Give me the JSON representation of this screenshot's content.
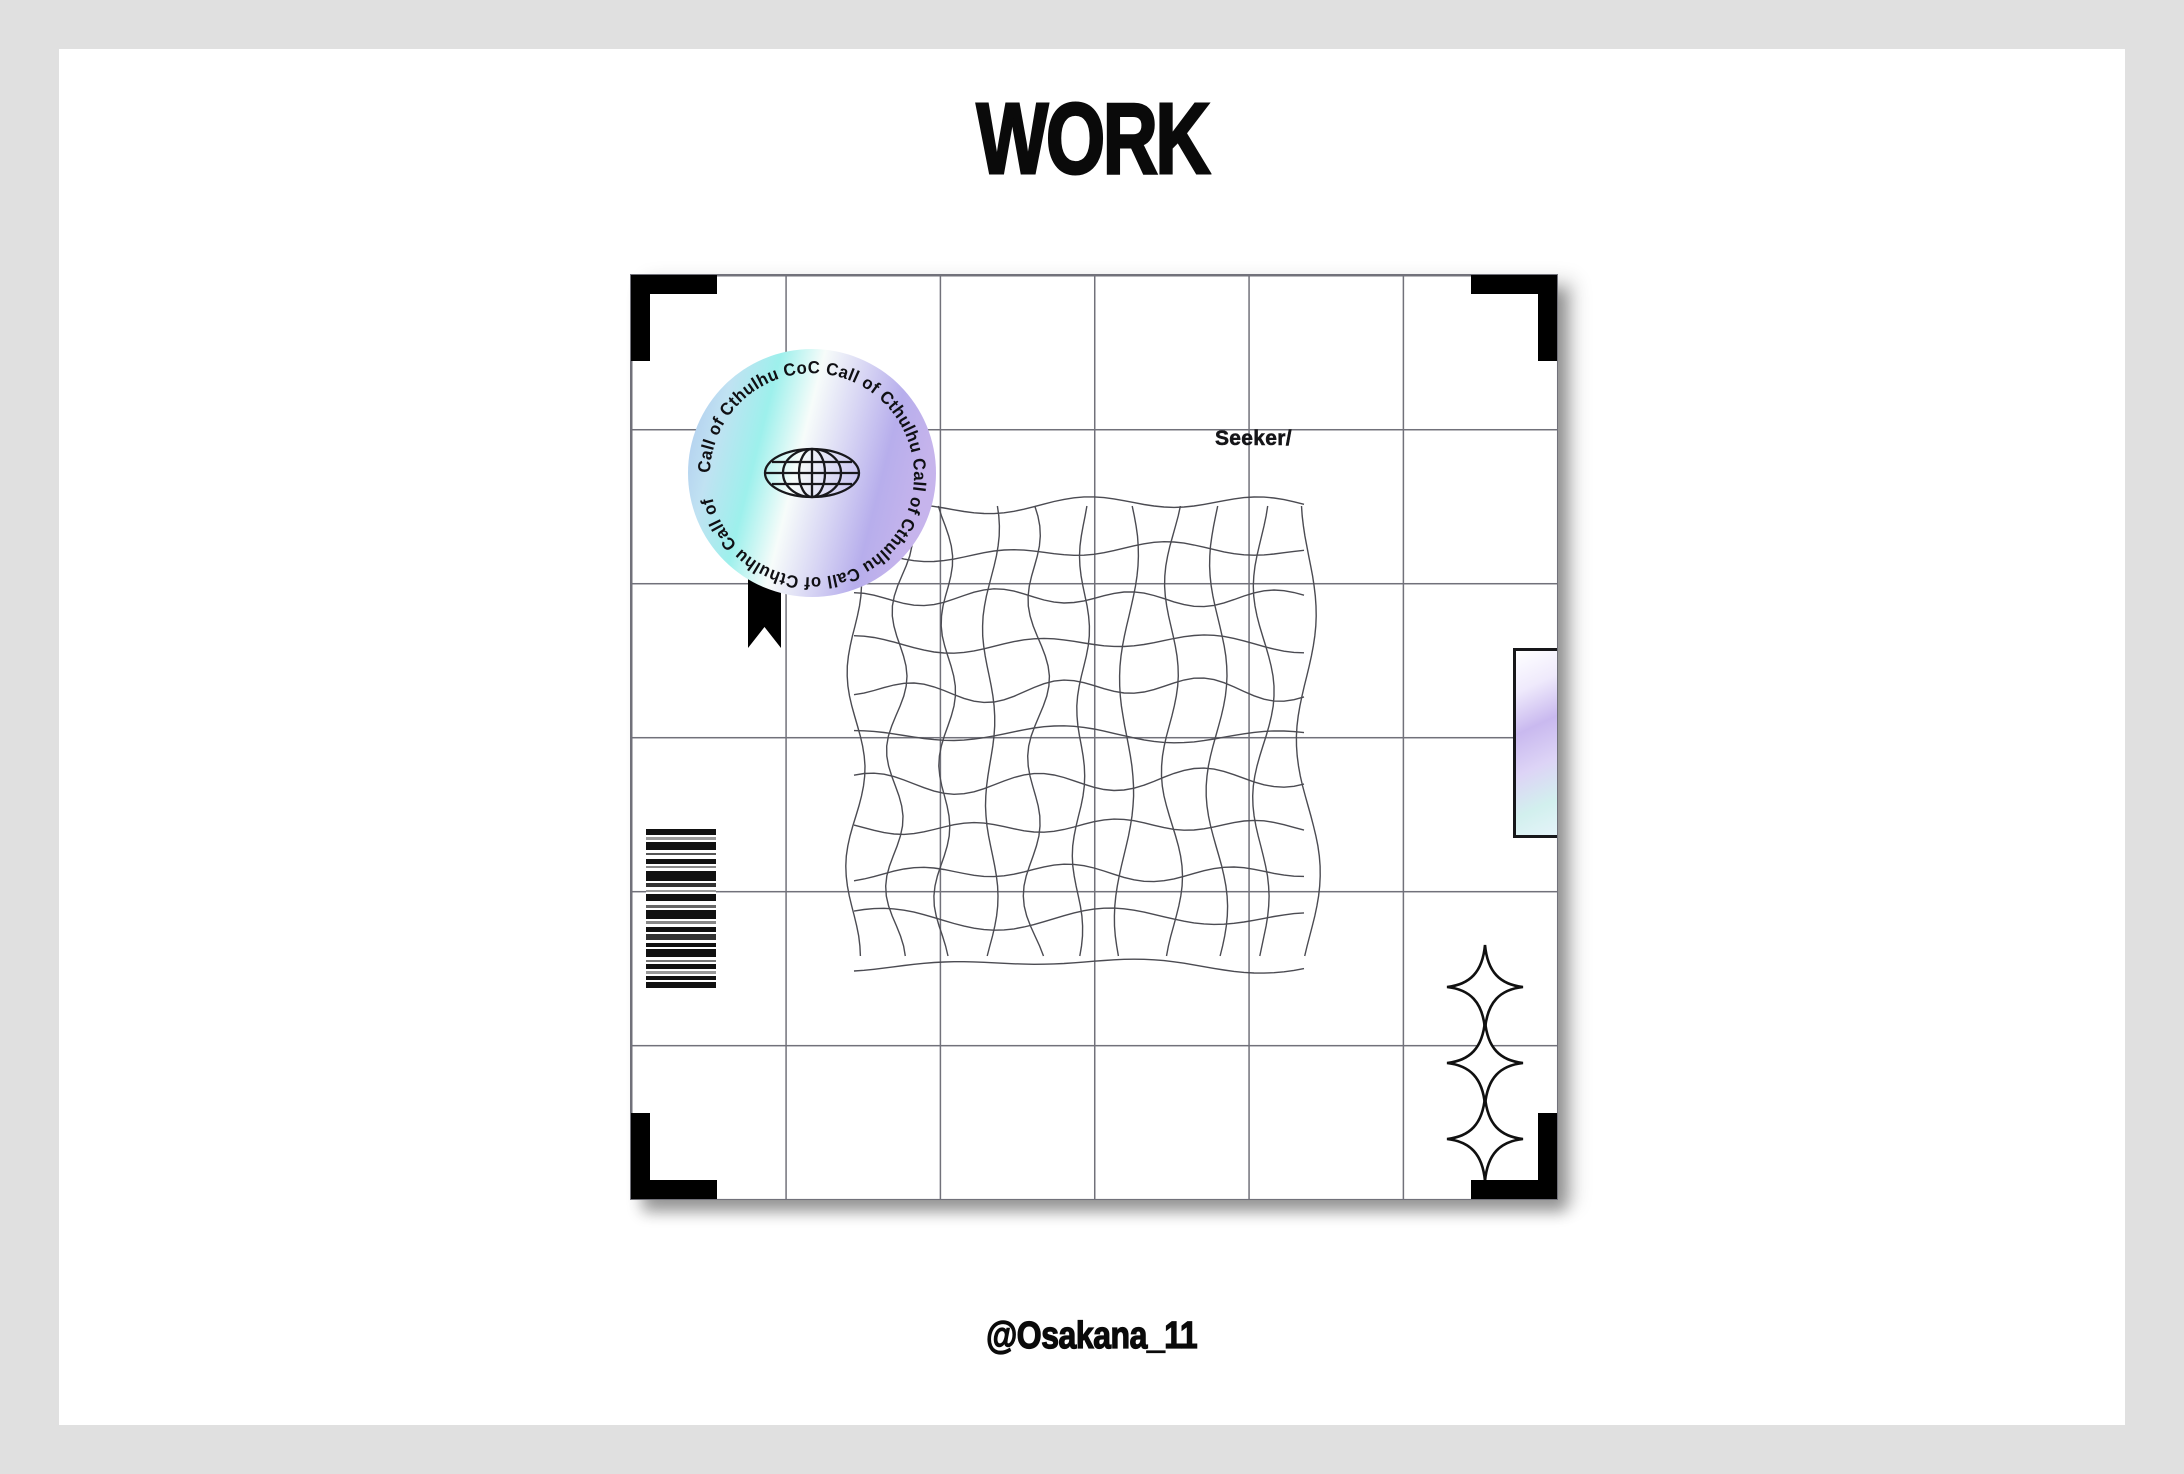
{
  "page": {
    "background": "#e0e0e0",
    "canvas_background": "#ffffff"
  },
  "header": {
    "title": "WORK"
  },
  "footer": {
    "credit": "@Osakana_11"
  },
  "card": {
    "label": "Seeker/",
    "grid": {
      "cols": 6,
      "rows": 6,
      "line_color": "#71717a"
    },
    "sticker": {
      "ring_text": "Call of Cthulhu  CoC   Call of Cthulhu Call of Cthulhu Call of Cthulhu Call of",
      "icon": "globe-icon",
      "gradient": [
        "#aec8ee",
        "#c0e2f2",
        "#9df0ec",
        "#f7fcfa",
        "#d8d6f4",
        "#b7aeec",
        "#c6b4ec"
      ]
    },
    "wavy_grid": {
      "lines": 11,
      "width": 454,
      "height": 458,
      "amplitude": 9,
      "color": "#4b4b52"
    },
    "barcode": {
      "bars": [
        [
          6,
          "#111111"
        ],
        [
          2,
          "#ffffff"
        ],
        [
          3,
          "#999999"
        ],
        [
          2,
          "#ffffff"
        ],
        [
          8,
          "#111111"
        ],
        [
          3,
          "#ffffff"
        ],
        [
          2,
          "#555555"
        ],
        [
          4,
          "#ffffff"
        ],
        [
          5,
          "#111111"
        ],
        [
          2,
          "#ffffff"
        ],
        [
          2,
          "#888888"
        ],
        [
          3,
          "#ffffff"
        ],
        [
          10,
          "#111111"
        ],
        [
          2,
          "#ffffff"
        ],
        [
          4,
          "#333333"
        ],
        [
          3,
          "#ffffff"
        ],
        [
          2,
          "#999999"
        ],
        [
          2,
          "#ffffff"
        ],
        [
          7,
          "#111111"
        ],
        [
          4,
          "#ffffff"
        ],
        [
          3,
          "#666666"
        ],
        [
          2,
          "#ffffff"
        ],
        [
          9,
          "#111111"
        ],
        [
          2,
          "#ffffff"
        ],
        [
          3,
          "#888888"
        ],
        [
          3,
          "#ffffff"
        ],
        [
          5,
          "#111111"
        ],
        [
          2,
          "#ffffff"
        ],
        [
          6,
          "#333333"
        ],
        [
          3,
          "#ffffff"
        ],
        [
          4,
          "#111111"
        ],
        [
          2,
          "#ffffff"
        ],
        [
          8,
          "#111111"
        ],
        [
          3,
          "#ffffff"
        ],
        [
          2,
          "#777777"
        ],
        [
          2,
          "#ffffff"
        ],
        [
          5,
          "#111111"
        ],
        [
          2,
          "#ffffff"
        ],
        [
          3,
          "#999999"
        ],
        [
          2,
          "#ffffff"
        ],
        [
          4,
          "#111111"
        ],
        [
          2,
          "#ffffff"
        ],
        [
          6,
          "#111111"
        ]
      ]
    },
    "holo_tag": {
      "gradient": [
        "#ffffff",
        "#efeafc",
        "#c9b9ef",
        "#ddd4f6",
        "#d2f0ee",
        "#e8f4fb"
      ]
    },
    "sparkles": {
      "count": 3,
      "color": "#101010"
    }
  }
}
